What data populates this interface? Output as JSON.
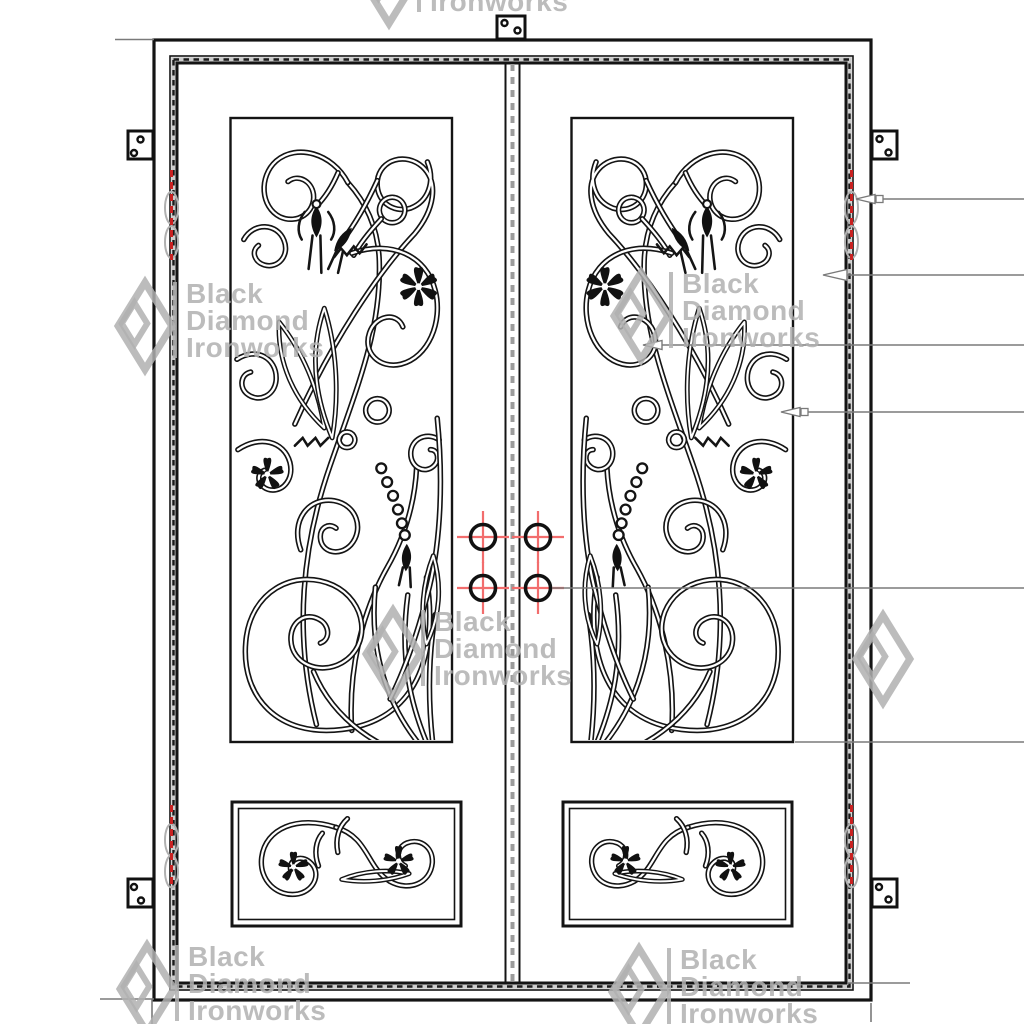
{
  "watermark": {
    "brand_line1": "Black",
    "brand_line2": "Diamond",
    "brand_line3": "Ironworks"
  },
  "drawing": {
    "description": "Double wrought-iron entry door elevation drawing",
    "colors": {
      "linework": "#141414",
      "leader": "#7a7a7a",
      "hinge_red": "#c92121",
      "crosshair_red": "#f26d6d",
      "watermark": "#b0b0b0",
      "seal_band": "#cccccc",
      "center_dash": "#9c9c9c"
    },
    "frame": {
      "x": 154,
      "y": 40,
      "w": 717,
      "h": 960
    },
    "door_outer": {
      "x": 170,
      "y": 56,
      "w": 683,
      "h": 934
    },
    "door_slab": {
      "x": 177,
      "y": 63,
      "w": 669,
      "h": 920
    },
    "center_x": 512.5,
    "meeting_stiles": [
      505.5,
      519.5
    ],
    "panels": {
      "left_upper": {
        "x": 230.5,
        "y": 118,
        "w": 221.5,
        "h": 624
      },
      "right_upper": {
        "x": 571.5,
        "y": 118,
        "w": 221.5,
        "h": 624
      },
      "left_lower": {
        "x": 232,
        "y": 802,
        "w": 229,
        "h": 124
      },
      "right_lower": {
        "x": 563,
        "y": 802,
        "w": 229,
        "h": 124
      }
    },
    "handle_points": [
      {
        "x": 483,
        "y": 537
      },
      {
        "x": 538,
        "y": 537
      },
      {
        "x": 483,
        "y": 588
      },
      {
        "x": 538,
        "y": 588
      }
    ],
    "leaders": [
      {
        "y": 199,
        "tip": 856,
        "end": 1024,
        "arrow": true,
        "len": 19,
        "square": true
      },
      {
        "y": 275,
        "tip": 823,
        "end": 1024,
        "arrow": true,
        "len": 24,
        "square": false
      },
      {
        "y": 345,
        "tip": 643,
        "end": 1024,
        "arrow": true,
        "len": 19,
        "square": false
      },
      {
        "y": 412,
        "tip": 781,
        "end": 1024,
        "arrow": true,
        "len": 19,
        "square": true
      },
      {
        "y": 588,
        "tip": 552,
        "end": 1024,
        "arrow": false,
        "len": 0,
        "square": false
      },
      {
        "y": 742,
        "tip": 795,
        "end": 1024,
        "arrow": false,
        "len": 0,
        "square": false
      },
      {
        "y": 983,
        "tip": 848,
        "end": 910,
        "arrow": false,
        "len": 0,
        "square": false
      }
    ],
    "tick_lines": [
      [
        115,
        39.5,
        154,
        39.5
      ],
      [
        100,
        999,
        154,
        999
      ],
      [
        152,
        999,
        152,
        1024
      ],
      [
        871,
        1003,
        871,
        1022
      ]
    ],
    "hinges": [
      {
        "x": 171.5,
        "y1": 170,
        "y2": 260
      },
      {
        "x": 171.5,
        "y1": 805,
        "y2": 888
      },
      {
        "x": 851.5,
        "y1": 170,
        "y2": 260
      },
      {
        "x": 851.5,
        "y1": 805,
        "y2": 888
      }
    ],
    "brackets": [
      {
        "x": 497,
        "y": 16,
        "w": 28,
        "h": 23,
        "holes": [
          [
            504.5,
            23
          ],
          [
            517.5,
            30.5
          ]
        ]
      },
      {
        "x": 128,
        "y": 131,
        "w": 25,
        "h": 28,
        "holes": [
          [
            140.5,
            139.5
          ],
          [
            134,
            153
          ]
        ]
      },
      {
        "x": 128,
        "y": 879,
        "w": 25,
        "h": 28,
        "holes": [
          [
            134,
            887
          ],
          [
            141,
            900.5
          ]
        ]
      },
      {
        "x": 872,
        "y": 131,
        "w": 25,
        "h": 28,
        "holes": [
          [
            879.5,
            139
          ],
          [
            888.5,
            152.5
          ]
        ]
      },
      {
        "x": 872,
        "y": 879,
        "w": 25,
        "h": 28,
        "holes": [
          [
            879,
            887
          ],
          [
            888.5,
            899.5
          ]
        ]
      }
    ]
  }
}
